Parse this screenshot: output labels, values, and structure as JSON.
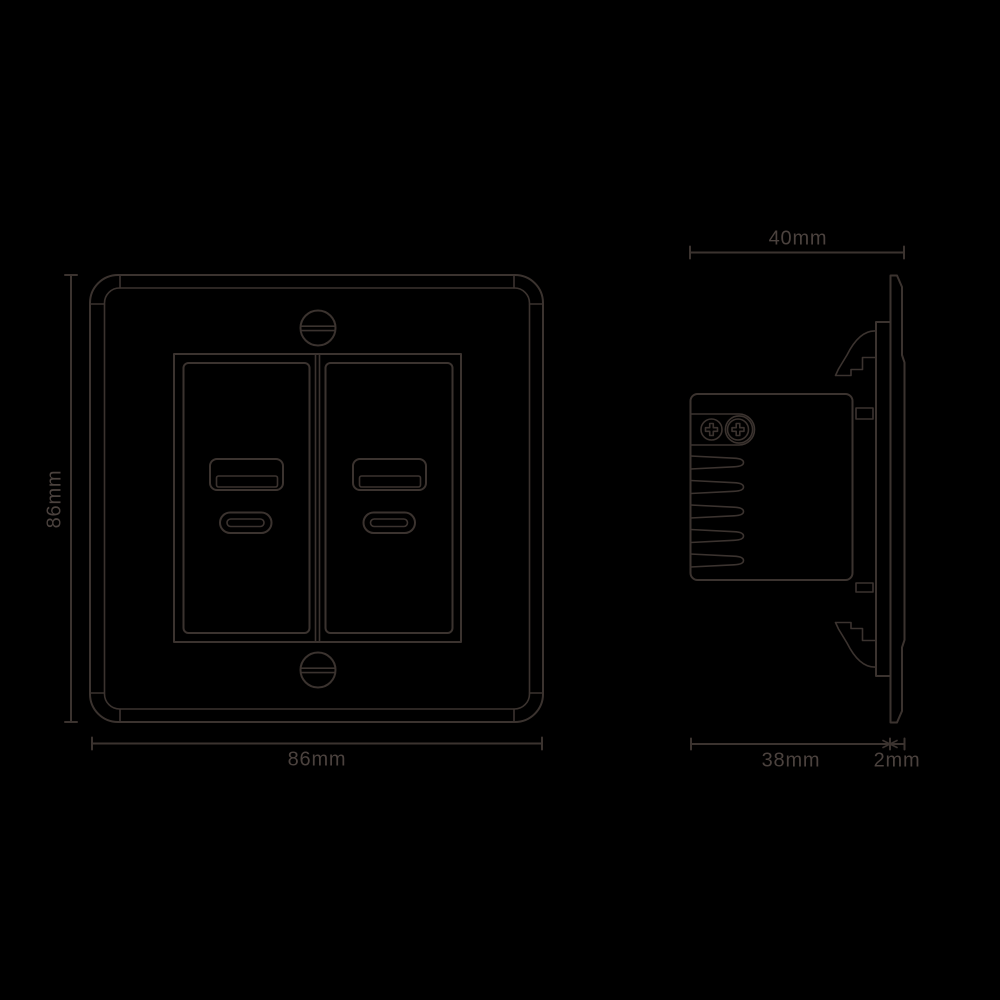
{
  "page": {
    "background": "#000000"
  },
  "drawing": {
    "line_color": "#3b332f",
    "text_color": "#4b423e",
    "dimensions": {
      "front_height": "86mm",
      "front_width": "86mm",
      "side_total_depth": "40mm",
      "side_body_depth": "38mm",
      "side_plate_thickness": "2mm"
    }
  }
}
